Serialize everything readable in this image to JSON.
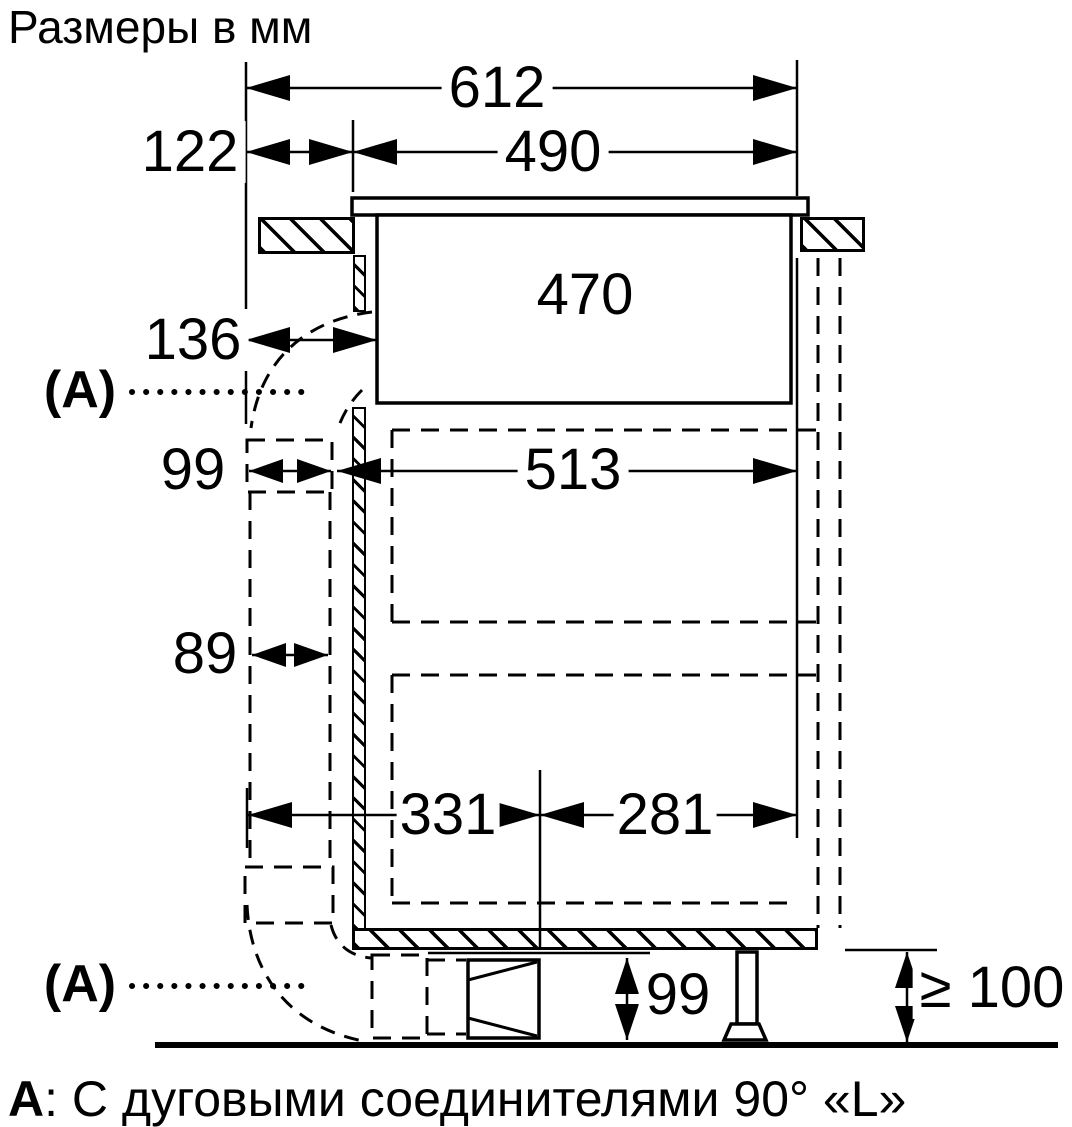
{
  "title": "Размеры в мм",
  "marker_a": "(А)",
  "dims": {
    "top_width": "612",
    "left_offset": "122",
    "cutout_width": "490",
    "hob_body_width": "470",
    "duct_offset": "136",
    "duct_width": "99",
    "cabinet_inner_width": "513",
    "channel_gap": "89",
    "bottom_left_span": "331",
    "bottom_right_span": "281",
    "plinth_height": "99",
    "floor_clearance": "≥ 100"
  },
  "caption": {
    "key": "А",
    "sep": ": ",
    "text": "С дуговыми соединителями 90° «L»"
  }
}
